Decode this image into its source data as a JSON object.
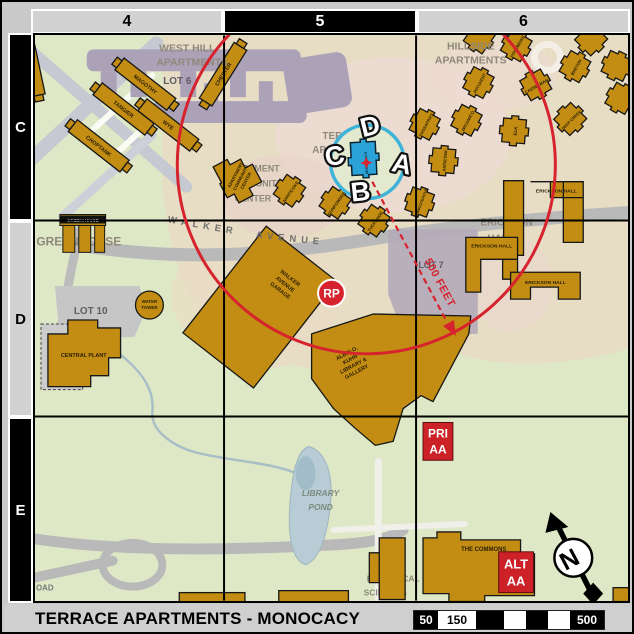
{
  "title_bar": {
    "title": "TERRACE APARTMENTS - MONOCACY"
  },
  "grid": {
    "columns": [
      "4",
      "5",
      "6"
    ],
    "rows": [
      "C",
      "D",
      "E"
    ]
  },
  "scale_bar": {
    "labels": [
      "50",
      "150",
      "500"
    ]
  },
  "colors": {
    "accent_red": "#d6232e",
    "building_gold": "#c28d12",
    "highlight_blue": "#2ba3d9",
    "radius_circle_blue": "#3eb3da",
    "marker_red": "#cc2127"
  },
  "map": {
    "areas": {
      "west_hill": [
        "WEST HILL",
        "APARTMENTS"
      ],
      "hillside": [
        "HILLSIDE",
        "APARTMENTS"
      ],
      "terrace": [
        "TERRACE",
        "APARTMENTS"
      ],
      "community_center": [
        "APARTMENT",
        "COMMUNITY",
        "CENTER"
      ],
      "erickson": [
        "ERICKSON",
        "HALL"
      ],
      "biological": [
        "BIOLOGICAL",
        "SCIENCES"
      ],
      "library_pond": [
        "LIBRARY",
        "POND"
      ],
      "greenhouse": "GREENHOUSE",
      "lot6": "LOT 6",
      "lot7": "LOT 7",
      "lot10": "LOT 10",
      "walker": "WALKER",
      "avenue": "AVENUE",
      "road_fragment": "OAD"
    },
    "buildings": {
      "west_hill": [
        "MAGOTHY",
        "TANGIER",
        "CHOPTANK",
        "WYE",
        "CHESTER"
      ],
      "terrace": [
        "NANTICOKE",
        "GUNPOWDER",
        "TUCKAHOE"
      ],
      "monocacy": "MONOCACY",
      "hillside": [
        "SASSAFRAS",
        "WICOMICO",
        "PATUXENT",
        "ELK",
        "CASSELMAN",
        "DEEP CREEK",
        "BRETON",
        "POCOMOKE",
        "CHINCOTEAGUE",
        "ANTIETAM"
      ],
      "community_center": [
        "APARTMENT",
        "COMMUNITY",
        "CENTER"
      ],
      "erickson_halls": [
        "ERICKSON HALL",
        "ERICKSON HALL",
        "ERICKSON HALL"
      ],
      "garage": [
        "WALKER",
        "AVENUE",
        "GARAGE"
      ],
      "library": [
        "ALBIN O.",
        "KUHN",
        "LIBRARY &",
        "GALLERY"
      ],
      "central_plant": "CENTRAL PLANT",
      "greenhouse": "GREENHOUSE",
      "water_tower": [
        "WATER",
        "TOWER"
      ],
      "commons": "THE COMMONS"
    },
    "unit_letters": [
      "A",
      "B",
      "C",
      "D"
    ],
    "markers": {
      "rp": "RP",
      "pri_aa": [
        "PRI",
        "AA"
      ],
      "alt_aa": [
        "ALT",
        "AA"
      ],
      "distance": "500 FEET",
      "north": "N"
    }
  }
}
